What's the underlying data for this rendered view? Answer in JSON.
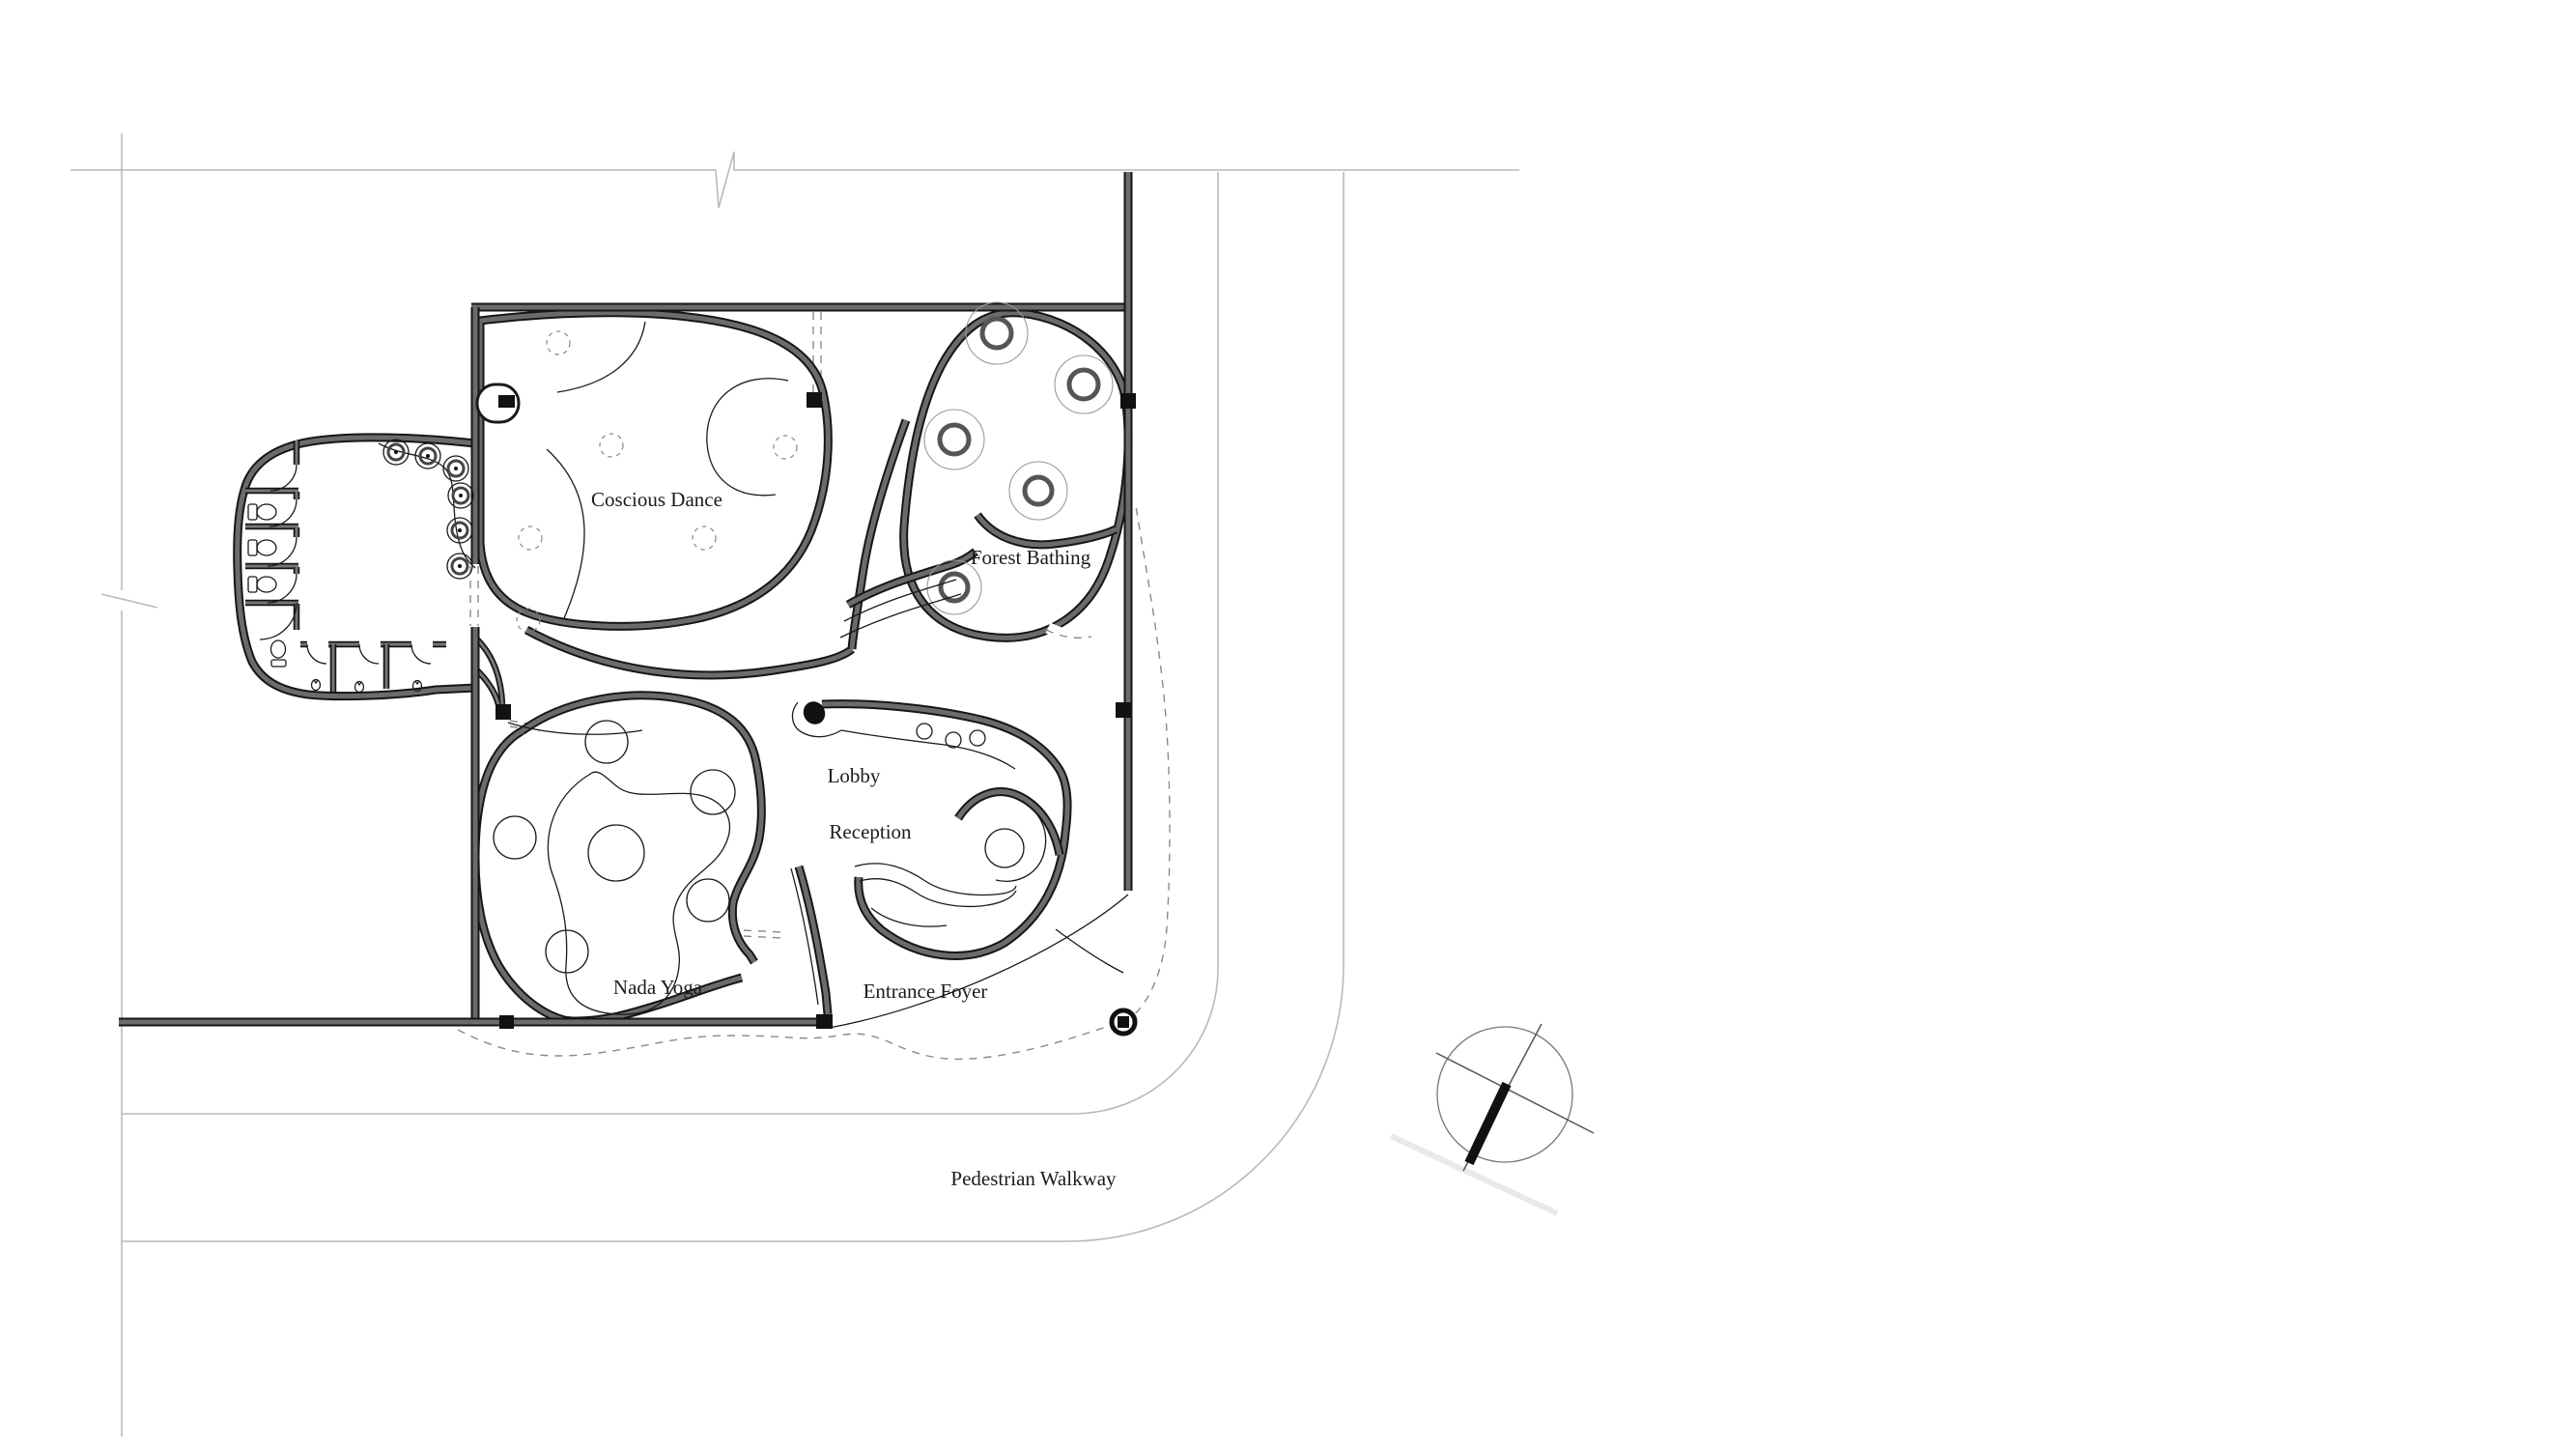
{
  "rooms": [
    {
      "id": "coscious-dance",
      "label": "Coscious Dance"
    },
    {
      "id": "forest-bathing",
      "label": "Forest Bathing"
    },
    {
      "id": "lobby",
      "label": "Lobby"
    },
    {
      "id": "reception",
      "label": "Reception"
    },
    {
      "id": "nada-yoga",
      "label": "Nada Yoga"
    },
    {
      "id": "entrance-foyer",
      "label": "Entrance Foyer"
    }
  ],
  "site": {
    "walkway_label": "Pedestrian Walkway"
  },
  "icons": {
    "north_arrow": "north-arrow-icon",
    "entry_marker": "entry-point-marker",
    "break_mark_top": "break-line-icon",
    "break_mark_left": "break-line-icon"
  },
  "colors": {
    "paper": "#ffffff",
    "wall_core": "#6b6b6b",
    "wall_edge": "#161616",
    "thin_line": "#1a1a1a",
    "faint_line": "#b9b9b9",
    "dashed_line": "#8a8a8a",
    "black": "#111111"
  }
}
